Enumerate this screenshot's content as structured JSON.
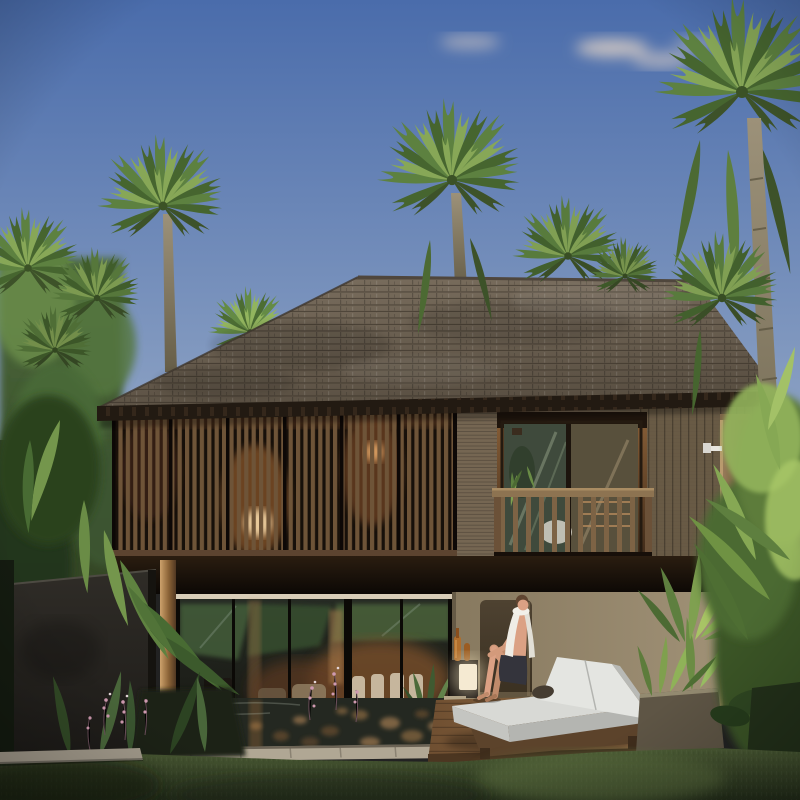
{
  "scene": {
    "title": "Tropical two-story pool villa at golden hour",
    "description": "Architectural rendering: wood-shingle hip roof, louvered upper facade with warm interior lamps, balcony with timber railing, full-height glass ground floor, koi reflecting pool, timber deck with white double daybed, seated man with towel, outdoor shower column, palm garden and lawn",
    "time_of_day": "late afternoon",
    "weather": "clear sky with thin clouds"
  },
  "palette": {
    "c-sky-top": "#4a6cab",
    "c-sky-bottom": "#8ea3c4",
    "c-cloud": "#e2d3c6",
    "c-palm-light": "#87a757",
    "c-palm-mid": "#5d8140",
    "c-palm-dark": "#46652f",
    "c-palm-droop": "#3d5229",
    "c-roof-light": "#7b6f5f",
    "c-roof-dark": "#584e41",
    "c-fascia": "#221a12",
    "c-slat": "#6e5438",
    "c-siding": "#756652",
    "c-rail-wood": "#8d7351",
    "c-band": "#1c130b",
    "c-glass": "#20241f",
    "c-beige-wall": "#a4957a",
    "c-niche": "#3a3021",
    "c-pool": "#242821",
    "c-pebble": "#6d5638",
    "c-coping": "#b0a794",
    "c-deck-light": "#a1784c",
    "c-deck-dark": "#6f4f31",
    "c-cushion": "#d8d9d5",
    "c-skin": "#dba184",
    "c-towel": "#efede6",
    "c-shorts": "#34343c",
    "c-grass-light": "#4c5c35",
    "c-grass-dark": "#232d1a",
    "c-wall-dark": "#2f2c27",
    "c-trunk": "#9c9179",
    "c-shower-wood": "#9c805d",
    "c-lamp-glow": "#e8c99a",
    "c-flower-pink": "#cf9ab0"
  },
  "inventory": {
    "vegetation": [
      "fan palms",
      "background trees",
      "pandanus",
      "dracaena",
      "planter shrubs",
      "orchid flower spikes",
      "lawn"
    ],
    "architecture": [
      "shingle hip roof",
      "vertical louver screen",
      "timber balcony railing",
      "sliding glass wall",
      "stucco wall with niche",
      "stone coping",
      "timber deck",
      "dark stone garden wall",
      "outdoor shower column"
    ],
    "props": [
      "double daybed",
      "white towel",
      "sun hat",
      "amber bottles",
      "cube lamp",
      "interior dining chairs",
      "snake plant"
    ],
    "people": [
      "man seated on daybed edge"
    ]
  }
}
